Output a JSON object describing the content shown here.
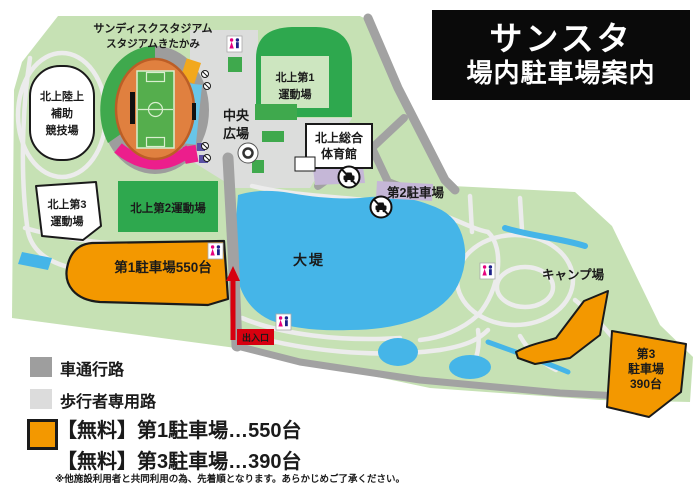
{
  "title": {
    "line1": "サンスタ",
    "line2": "場内駐車場案内"
  },
  "map": {
    "stadium_name_line1": "サンディスクスタジアム",
    "stadium_name_line2": "スタジアムきたかみ",
    "sub_track_line1": "北上陸上",
    "sub_track_line2": "補助",
    "sub_track_line3": "競技場",
    "field1_line1": "北上第1",
    "field1_line2": "運動場",
    "field2_label": "北上第2運動場",
    "field3_line1": "北上第3",
    "field3_line2": "運動場",
    "plaza_line1": "中央",
    "plaza_line2": "広場",
    "gym_line1": "北上総合",
    "gym_line2": "体育館",
    "parking2_label": "第2駐車場",
    "pond_label": "大堤",
    "camp_label": "キャンプ場",
    "parking1_label": "第1駐車場550台",
    "parking3_line1": "第3",
    "parking3_line2": "駐車場",
    "parking3_line3": "390台",
    "gate_label": "出入口"
  },
  "legend": {
    "road_label": "車通行路",
    "path_label": "歩行者専用路",
    "free1_label": "【無料】第1駐車場…550台",
    "free3_label": "【無料】第3駐車場…390台",
    "note": "※他施設利用者と共同利用の為、先着順となります。あらかじめご了承ください。"
  },
  "icons": {
    "restroom": "restroom-icon",
    "no_parking": "no-parking-icon",
    "entrance_arrow": "entrance-arrow-icon"
  },
  "colors": {
    "park_green": "#c6e1b4",
    "field_green": "#2ea84e",
    "plaza_gray": "#dcdddc",
    "pond_blue": "#45b5e8",
    "parking_orange": "#f39800",
    "parking2_lavender": "#c5b7d7",
    "road_gray": "#a2a2a2",
    "walk_path": "#ececec",
    "track_orange": "#e0803f",
    "stand_cyan": "#68c5e8",
    "stand_pink": "#ec1e8c",
    "stand_purple": "#5a50a4",
    "accent_red": "#d7000f",
    "title_bg": "#0a0a0a"
  }
}
